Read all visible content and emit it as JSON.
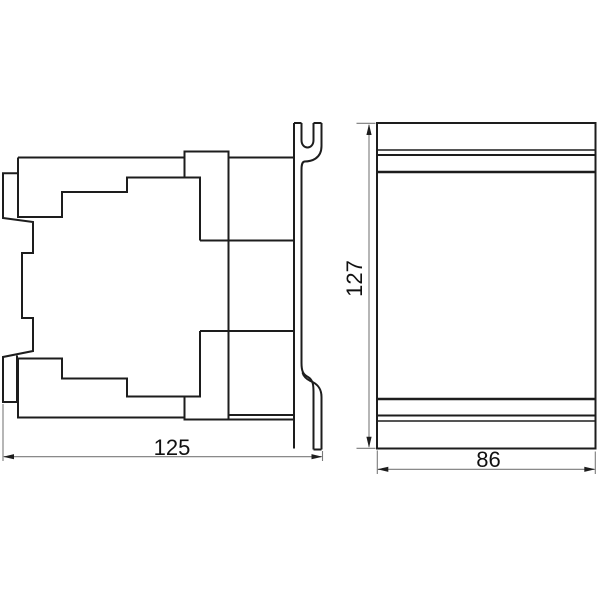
{
  "drawing": {
    "kind": "technical-dimension-drawing",
    "background_color": "#ffffff",
    "outline_color": "#1d1d1d",
    "dimension_line_color": "#7a7a7a",
    "text_color": "#111111",
    "views": [
      {
        "id": "side-view",
        "position": "left"
      },
      {
        "id": "front-view",
        "position": "right"
      }
    ],
    "dimensions": {
      "depth": {
        "value": "125",
        "orientation": "horizontal",
        "view": "side-view"
      },
      "height": {
        "value": "127",
        "orientation": "vertical",
        "view": "front-view"
      },
      "width": {
        "value": "86",
        "orientation": "horizontal",
        "view": "front-view"
      }
    }
  }
}
